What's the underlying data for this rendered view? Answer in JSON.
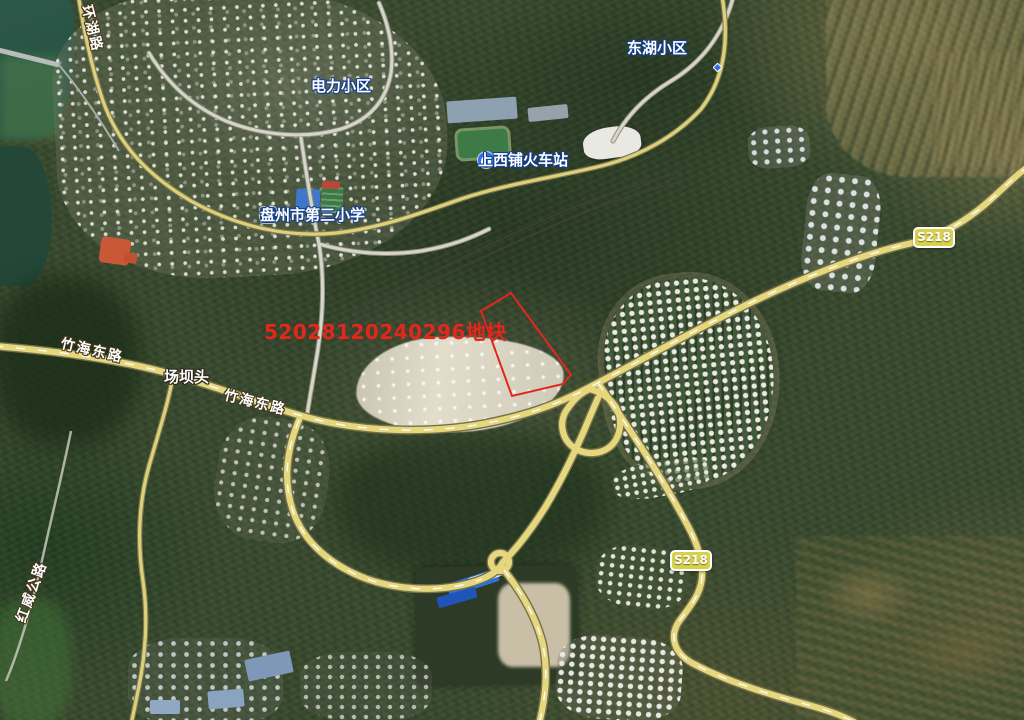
{
  "map": {
    "view": "satellite",
    "parcel": {
      "label": "52028120240296地块",
      "outline_color": "#e0281e"
    },
    "road_labels": [
      {
        "id": "huanhu-road",
        "text": "环湖路"
      },
      {
        "id": "zhuhai-east-road-1",
        "text": "竹海东路"
      },
      {
        "id": "zhuhai-east-road-2",
        "text": "竹海东路"
      },
      {
        "id": "hongwei-highway",
        "text": "红威公路"
      }
    ],
    "place_labels": [
      {
        "id": "supermarket",
        "text": "永兴大盛生活超市"
      },
      {
        "id": "donghu-xiaoqu",
        "text": "东湖小区"
      },
      {
        "id": "dianli-xiaoqu",
        "text": "电力小区"
      },
      {
        "id": "changbatou",
        "text": "场坝头"
      }
    ],
    "poi_labels": [
      {
        "id": "shangxipu-station",
        "text": "上西铺火车站",
        "icon": "train-station-icon"
      },
      {
        "id": "panzhou-no3-primary-school",
        "text": "盘州市第三小学",
        "icon": "school-icon"
      }
    ],
    "road_badges": [
      {
        "text": "S218"
      },
      {
        "text": "S218"
      }
    ],
    "colors": {
      "major_road": "#e5d77d",
      "badge_bg": "#d9d04c",
      "water": "#2b5548"
    }
  }
}
